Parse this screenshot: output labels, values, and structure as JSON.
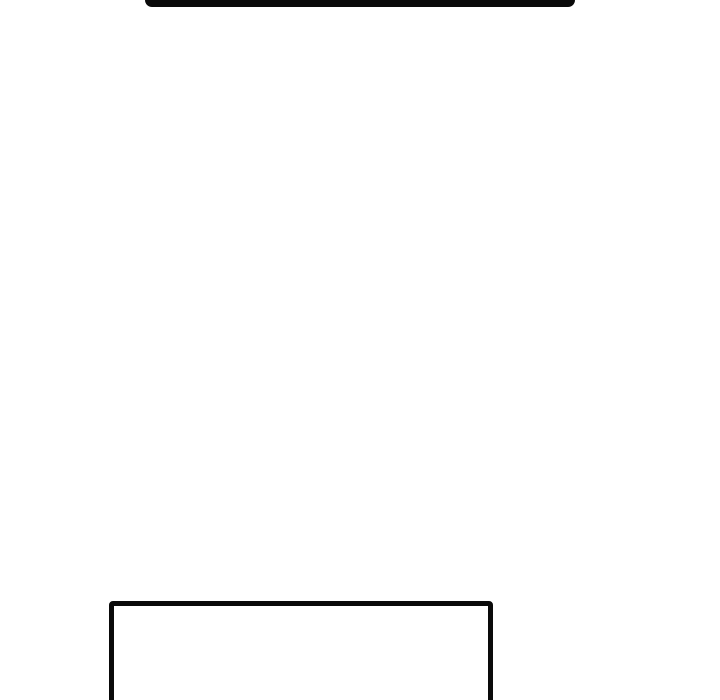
{
  "page": {
    "background_color": "#ffffff"
  },
  "panels": {
    "stroke_color": "#0a0a0a",
    "items": [
      {
        "name": "top-panel",
        "visible_part": "bottom edge only, cropped by top of frame",
        "text": ""
      },
      {
        "name": "bottom-panel",
        "visible_part": "top, left and right edges, cropped by bottom of frame",
        "text": ""
      }
    ]
  }
}
